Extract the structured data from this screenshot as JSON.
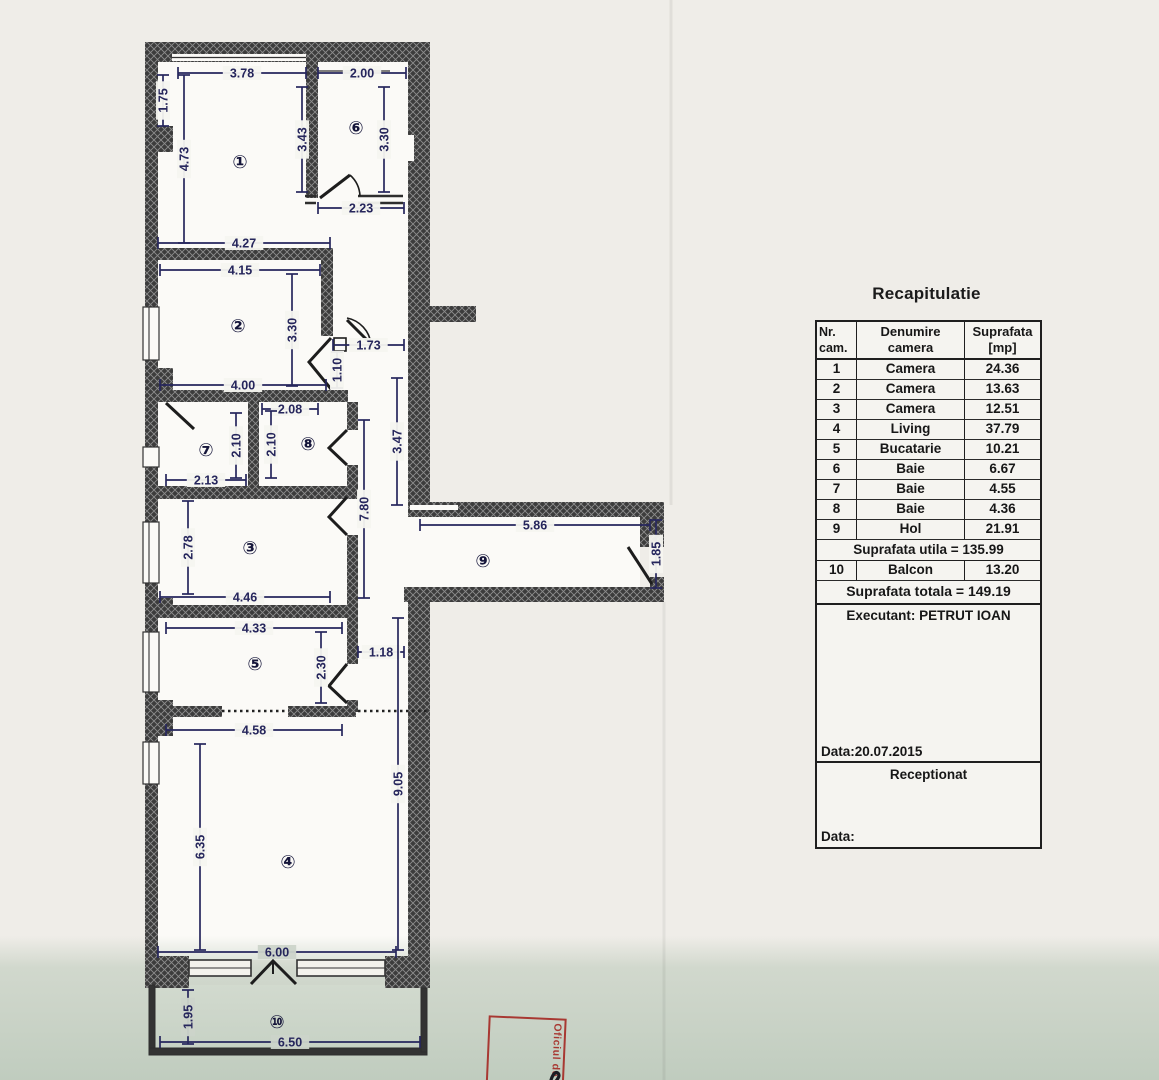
{
  "title": "Recapitulatie",
  "table": {
    "headers": [
      [
        "Nr.",
        "cam."
      ],
      [
        "Denumire",
        "camera"
      ],
      [
        "Suprafata",
        "[mp]"
      ]
    ],
    "rows": [
      [
        "1",
        "Camera",
        "24.36"
      ],
      [
        "2",
        "Camera",
        "13.63"
      ],
      [
        "3",
        "Camera",
        "12.51"
      ],
      [
        "4",
        "Living",
        "37.79"
      ],
      [
        "5",
        "Bucatarie",
        "10.21"
      ],
      [
        "6",
        "Baie",
        "6.67"
      ],
      [
        "7",
        "Baie",
        "4.55"
      ],
      [
        "8",
        "Baie",
        "4.36"
      ],
      [
        "9",
        "Hol",
        "21.91"
      ]
    ],
    "subtotal": "Suprafata utila = 135.99",
    "balcon_row": [
      "10",
      "Balcon",
      "13.20"
    ],
    "total": "Suprafata totala = 149.19",
    "executant": "Executant: PETRUT IOAN",
    "date_line": "Data:20.07.2015",
    "receptionat": "Receptionat",
    "data_label": "Data:"
  },
  "stamp": {
    "text": "Oficiul de C"
  },
  "plan": {
    "dim_color": "#26265c",
    "paper_color": "#f6f5f0",
    "green_paper": "#ccd4ca",
    "dims": [
      {
        "label": "3.78",
        "x1": 178,
        "y1": 73,
        "x2": 306,
        "y2": 73
      },
      {
        "label": "2.00",
        "x1": 318,
        "y1": 73,
        "x2": 406,
        "y2": 73
      },
      {
        "label": "1.75",
        "x1": 163,
        "y1": 75,
        "x2": 163,
        "y2": 126
      },
      {
        "label": "4.73",
        "x1": 184,
        "y1": 75,
        "x2": 184,
        "y2": 243
      },
      {
        "label": "3.43",
        "x1": 302,
        "y1": 87,
        "x2": 302,
        "y2": 192
      },
      {
        "label": "3.30",
        "x1": 384,
        "y1": 87,
        "x2": 384,
        "y2": 192
      },
      {
        "label": "2.23",
        "x1": 318,
        "y1": 208,
        "x2": 404,
        "y2": 208
      },
      {
        "label": "4.27",
        "x1": 158,
        "y1": 243,
        "x2": 330,
        "y2": 243
      },
      {
        "label": "4.15",
        "x1": 160,
        "y1": 270,
        "x2": 320,
        "y2": 270
      },
      {
        "label": "3.30",
        "x1": 292,
        "y1": 274,
        "x2": 292,
        "y2": 386
      },
      {
        "label": "1.73",
        "x1": 333,
        "y1": 345,
        "x2": 404,
        "y2": 345
      },
      {
        "label": "1.10",
        "x1": 337,
        "y1": 352,
        "x2": 337,
        "y2": 388
      },
      {
        "label": "4.00",
        "x1": 160,
        "y1": 385,
        "x2": 326,
        "y2": 385
      },
      {
        "label": "2.08",
        "x1": 262,
        "y1": 409,
        "x2": 318,
        "y2": 409
      },
      {
        "label": "2.10",
        "x1": 236,
        "y1": 413,
        "x2": 236,
        "y2": 478
      },
      {
        "label": "2.10",
        "x1": 271,
        "y1": 411,
        "x2": 271,
        "y2": 478
      },
      {
        "label": "2.13",
        "x1": 166,
        "y1": 480,
        "x2": 246,
        "y2": 480
      },
      {
        "label": "3.47",
        "x1": 397,
        "y1": 378,
        "x2": 397,
        "y2": 505
      },
      {
        "label": "2.78",
        "x1": 188,
        "y1": 501,
        "x2": 188,
        "y2": 594
      },
      {
        "label": "7.80",
        "x1": 364,
        "y1": 420,
        "x2": 364,
        "y2": 598
      },
      {
        "label": "4.46",
        "x1": 160,
        "y1": 597,
        "x2": 330,
        "y2": 597
      },
      {
        "label": "5.86",
        "x1": 420,
        "y1": 525,
        "x2": 650,
        "y2": 525
      },
      {
        "label": "1.85",
        "x1": 656,
        "y1": 520,
        "x2": 656,
        "y2": 588
      },
      {
        "label": "4.33",
        "x1": 166,
        "y1": 628,
        "x2": 342,
        "y2": 628
      },
      {
        "label": "1.18",
        "x1": 358,
        "y1": 652,
        "x2": 404,
        "y2": 652
      },
      {
        "label": "2.30",
        "x1": 321,
        "y1": 632,
        "x2": 321,
        "y2": 703
      },
      {
        "label": "4.58",
        "x1": 166,
        "y1": 730,
        "x2": 342,
        "y2": 730
      },
      {
        "label": "9.05",
        "x1": 398,
        "y1": 618,
        "x2": 398,
        "y2": 950
      },
      {
        "label": "6.35",
        "x1": 200,
        "y1": 744,
        "x2": 200,
        "y2": 950
      },
      {
        "label": "6.00",
        "x1": 158,
        "y1": 952,
        "x2": 396,
        "y2": 952
      },
      {
        "label": "1.95",
        "x1": 188,
        "y1": 990,
        "x2": 188,
        "y2": 1044
      },
      {
        "label": "6.50",
        "x1": 160,
        "y1": 1042,
        "x2": 420,
        "y2": 1042
      }
    ],
    "rooms": [
      {
        "label": "①",
        "x": 240,
        "y": 162
      },
      {
        "label": "⑥",
        "x": 356,
        "y": 128
      },
      {
        "label": "②",
        "x": 238,
        "y": 326
      },
      {
        "label": "⑦",
        "x": 206,
        "y": 450
      },
      {
        "label": "⑧",
        "x": 308,
        "y": 444
      },
      {
        "label": "③",
        "x": 250,
        "y": 548
      },
      {
        "label": "⑨",
        "x": 483,
        "y": 561
      },
      {
        "label": "⑤",
        "x": 255,
        "y": 664
      },
      {
        "label": "④",
        "x": 288,
        "y": 862
      },
      {
        "label": "⑩",
        "x": 277,
        "y": 1022
      }
    ]
  }
}
